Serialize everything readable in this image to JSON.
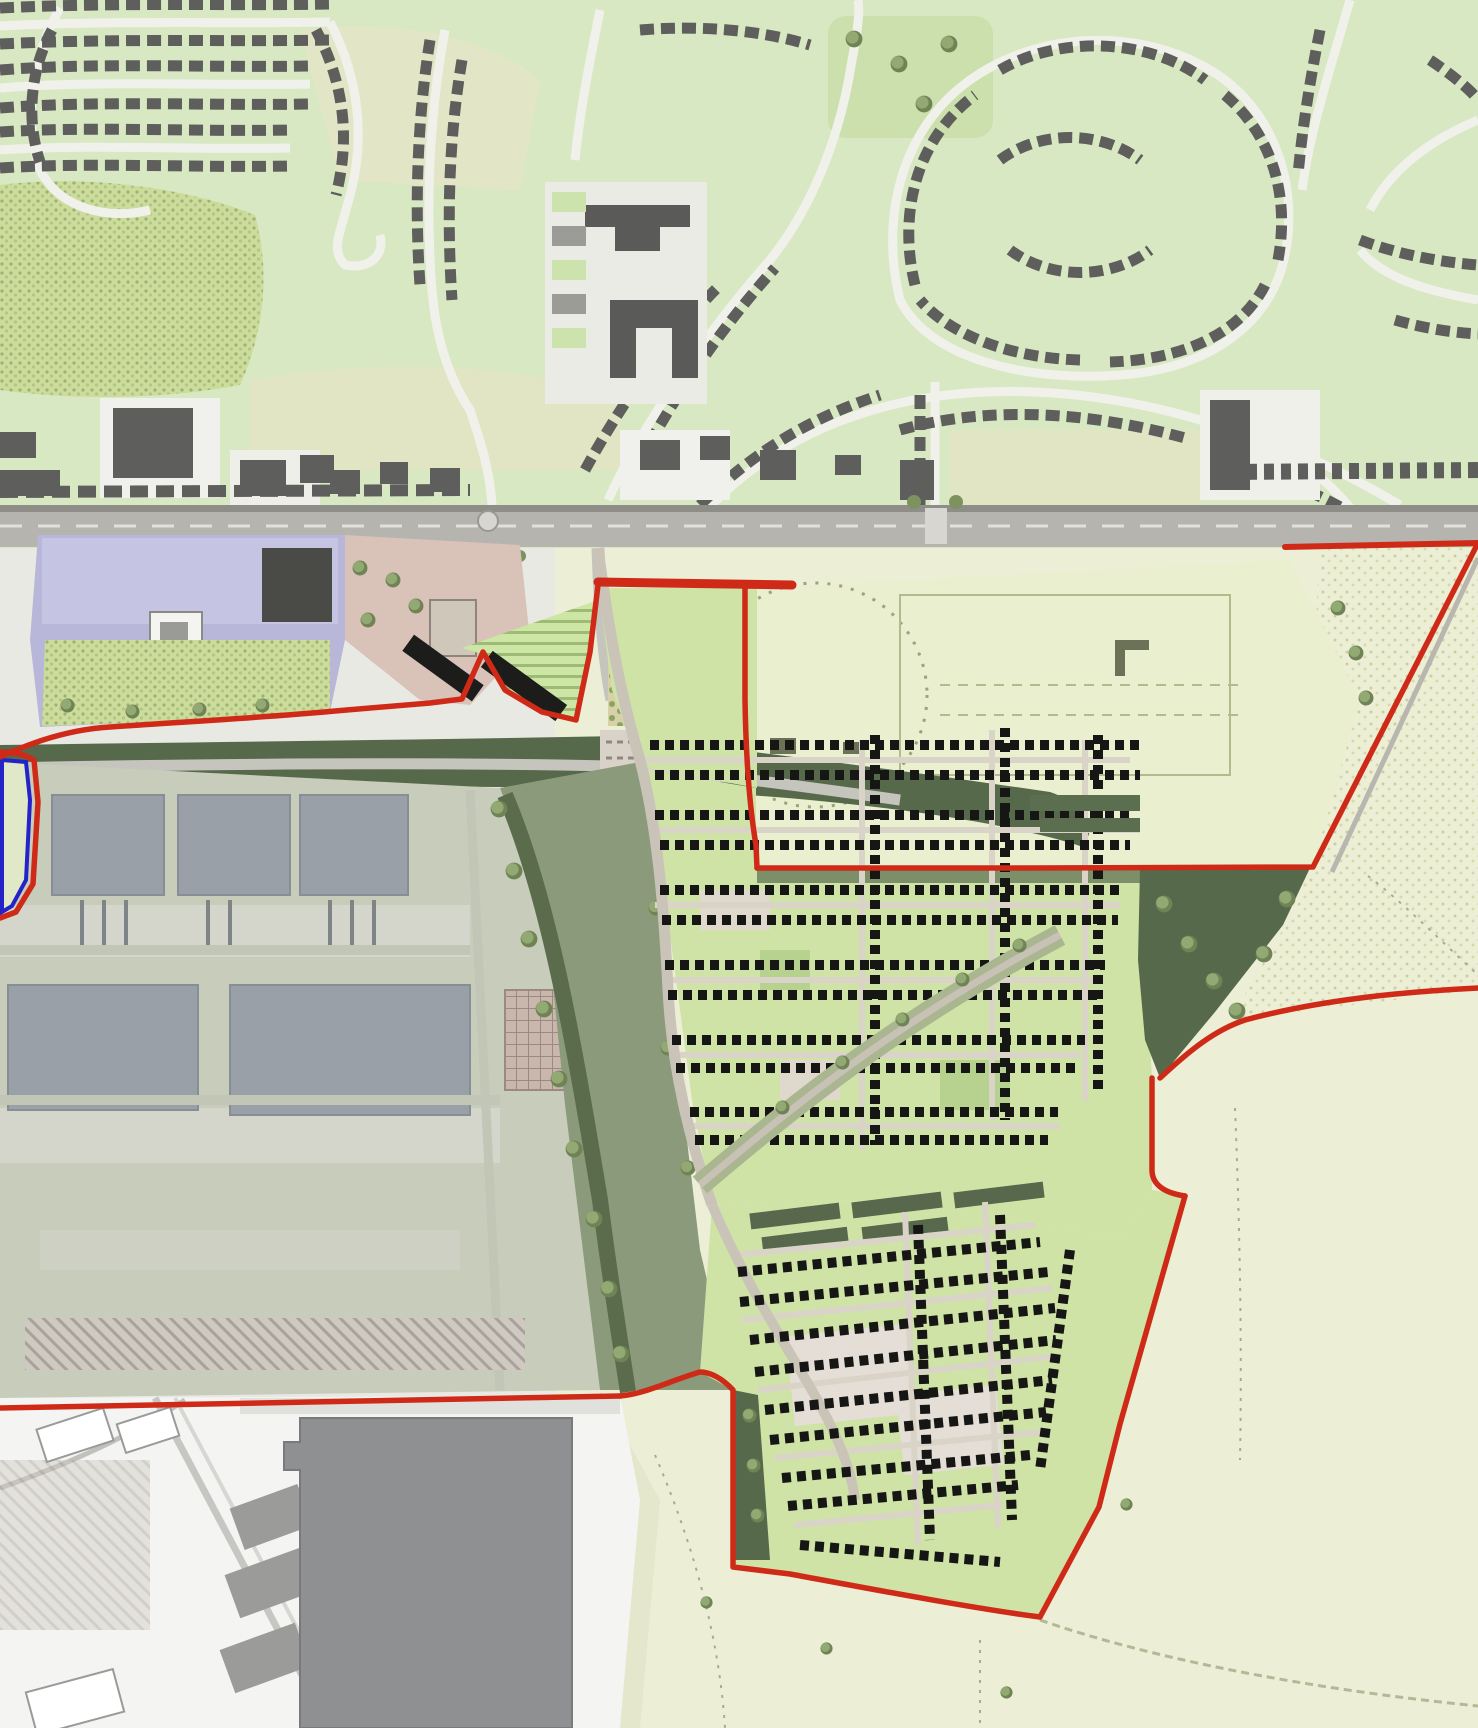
{
  "map": {
    "title": "Masterplan site plan over Ordnance Survey style base map",
    "aria_label": "Development masterplan site plan: red line application boundary enclosing new housing, employment warehouses, playing fields, allotments and woodland, surrounded by existing suburban streets to the north, an industrial estate to the south-west and open farmland to the east and south",
    "boundaries": {
      "red_line": {
        "color": "#cf2a18",
        "meaning": "application site boundary (red line)"
      },
      "blue_line": {
        "color": "#2323c8",
        "meaning": "secondary land parcel boundary (blue line)"
      }
    },
    "palette": {
      "os_green": "#d8e8c2",
      "os_beige": "#e2e5c3",
      "os_road_white": "#f1f1ec",
      "os_building_grey": "#5e5e5c",
      "road_grey": "#b6b4ae",
      "plan_playing_field": "#e9efcf",
      "plan_housing_green": "#cfe3a6",
      "plan_house_black": "#161614",
      "open_space_sage": "#8a9a7a",
      "tree_belt_dark": "#57694b",
      "woodland_stipple": "#ccdc9b",
      "lavender_parcel": "#b8b7da",
      "school_grounds_pink": "#d9c2b8",
      "warehouse_roof_grey": "#9aa0a8",
      "warehouse_ground": "#c8ccba",
      "industrial_white": "#f4f4f2",
      "big_warehouse_grey": "#8e9092",
      "farmland_pale": "#ecefd6"
    },
    "regions": [
      {
        "id": "existing-urban-area",
        "name": "Existing suburban streets and housing (north of main road)"
      },
      {
        "id": "existing-school",
        "name": "Existing school complex"
      },
      {
        "id": "main-road",
        "name": "Main east-west road"
      },
      {
        "id": "lavender-parcel",
        "name": "Lavender institutional parcel"
      },
      {
        "id": "school-grounds-pink",
        "name": "Pink school grounds with buildings"
      },
      {
        "id": "woodland-copse",
        "name": "Retained woodland copse"
      },
      {
        "id": "allotments",
        "name": "Allotments / growing plots"
      },
      {
        "id": "orchard",
        "name": "Orchard rows"
      },
      {
        "id": "new-community-building",
        "name": "New school / community building"
      },
      {
        "id": "playing-fields",
        "name": "Playing fields with cricket circle"
      },
      {
        "id": "employment-warehouses",
        "name": "Employment area warehouses"
      },
      {
        "id": "warehouse-parking",
        "name": "Warehouse car parking"
      },
      {
        "id": "open-space-corridor",
        "name": "Green open space corridor"
      },
      {
        "id": "housing-north",
        "name": "New residential masterplan - northern parcel"
      },
      {
        "id": "housing-south",
        "name": "New residential masterplan - southern parcel"
      },
      {
        "id": "green-boulevard",
        "name": "Tree-lined green boulevard"
      },
      {
        "id": "tree-belts",
        "name": "Structural tree belts"
      },
      {
        "id": "east-farmland",
        "name": "Open farmland east of site"
      },
      {
        "id": "south-farmland",
        "name": "Open farmland south of site"
      },
      {
        "id": "industrial-estate",
        "name": "Existing industrial estate (south-west)"
      },
      {
        "id": "big-warehouse",
        "name": "Large existing warehouse building"
      },
      {
        "id": "blue-line-parcel",
        "name": "Blue line parcel at western edge"
      }
    ]
  }
}
